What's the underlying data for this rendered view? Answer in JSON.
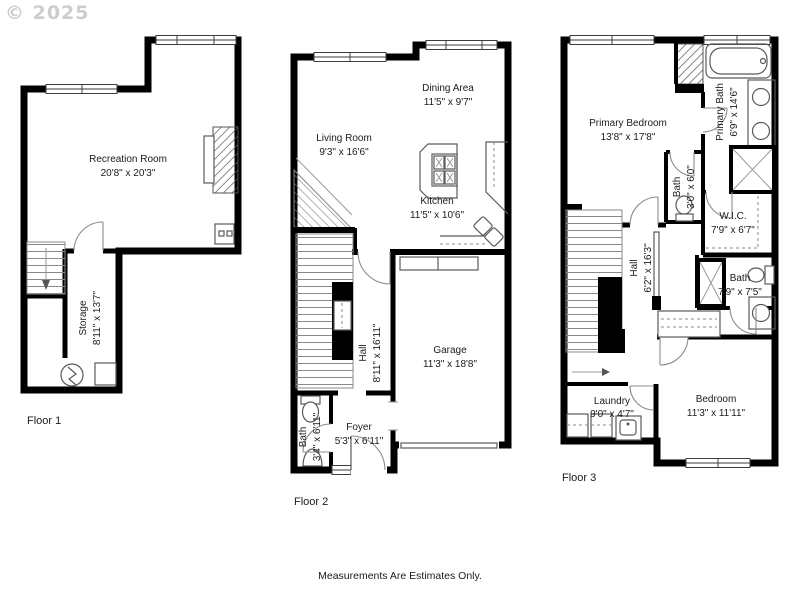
{
  "watermark": "© 2025",
  "footer": {
    "text": "Measurements Are Estimates Only."
  },
  "colors": {
    "wall": "#000000",
    "fixture_line": "#5a5a5a",
    "watermark": "#cdcdcd",
    "background": "#ffffff",
    "text": "#1b1b1b"
  },
  "floor1": {
    "label": "Floor 1",
    "recreation_room": {
      "name": "Recreation Room",
      "dims": "20'8\" x 20'3\""
    },
    "storage": {
      "name": "Storage",
      "dims": "8'11\" x 13'7\""
    }
  },
  "floor2": {
    "label": "Floor 2",
    "living_room": {
      "name": "Living Room",
      "dims": "9'3\" x 16'6\""
    },
    "dining_area": {
      "name": "Dining Area",
      "dims": "11'5\" x 9'7\""
    },
    "kitchen": {
      "name": "Kitchen",
      "dims": "11'5\" x 10'6\""
    },
    "hall": {
      "name": "Hall",
      "dims": "8'11\" x 16'11\""
    },
    "garage": {
      "name": "Garage",
      "dims": "11'3\" x 18'8\""
    },
    "bath": {
      "name": "Bath",
      "dims": "3'4\" x 6'11\""
    },
    "foyer": {
      "name": "Foyer",
      "dims": "5'3\" x 6'11\""
    }
  },
  "floor3": {
    "label": "Floor 3",
    "primary_bedroom": {
      "name": "Primary Bedroom",
      "dims": "13'8\" x 17'8\""
    },
    "primary_bath": {
      "name": "Primary Bath",
      "dims": "6'9\" x 14'6\""
    },
    "bath_small": {
      "name": "Bath",
      "dims": "3'0\" x 6'0\""
    },
    "wic": {
      "name": "W.I.C.",
      "dims": "7'9\" x 6'7\""
    },
    "hall": {
      "name": "Hall",
      "dims": "6'2\" x 16'3\""
    },
    "bath": {
      "name": "Bath",
      "dims": "7'9\" x 7'5\""
    },
    "laundry": {
      "name": "Laundry",
      "dims": "9'0\" x 4'7\""
    },
    "bedroom": {
      "name": "Bedroom",
      "dims": "11'3\" x 11'11\""
    }
  }
}
